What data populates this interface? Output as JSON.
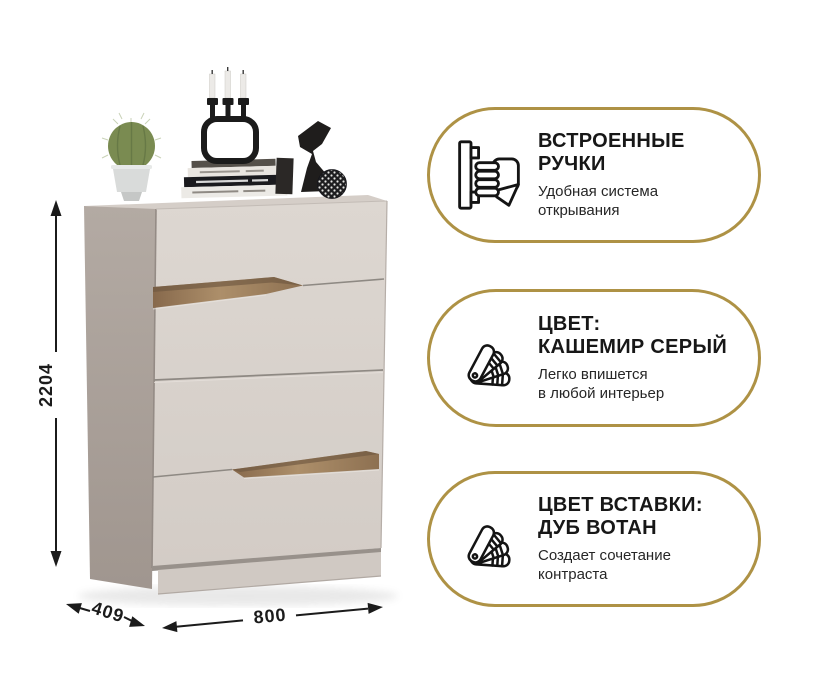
{
  "dimensions": {
    "height": "2204",
    "depth": "409",
    "width": "800"
  },
  "badges": [
    {
      "icon": "built-in-handle-icon",
      "title1": "ВСТРОЕННЫЕ",
      "title2": "РУЧКИ",
      "sub1": "Удобная система",
      "sub2": "открывания"
    },
    {
      "icon": "color-swatch-fan-icon",
      "title1": "ЦВЕТ:",
      "title2": "КАШЕМИР СЕРЫЙ",
      "sub1": "Легко впишется",
      "sub2": "в любой интерьер"
    },
    {
      "icon": "color-swatch-fan-icon",
      "title1": "ЦВЕТ ВСТАВКИ:",
      "title2": "ДУБ ВОТАН",
      "sub1": "Создает сочетание",
      "sub2": "контраста"
    }
  ],
  "colors": {
    "accent_gold": "#ae9245",
    "front_cashmere": "#d9d3cd",
    "side_shade": "#aba198",
    "wood_insert": "#a2855f",
    "text": "#1c1c1c"
  }
}
